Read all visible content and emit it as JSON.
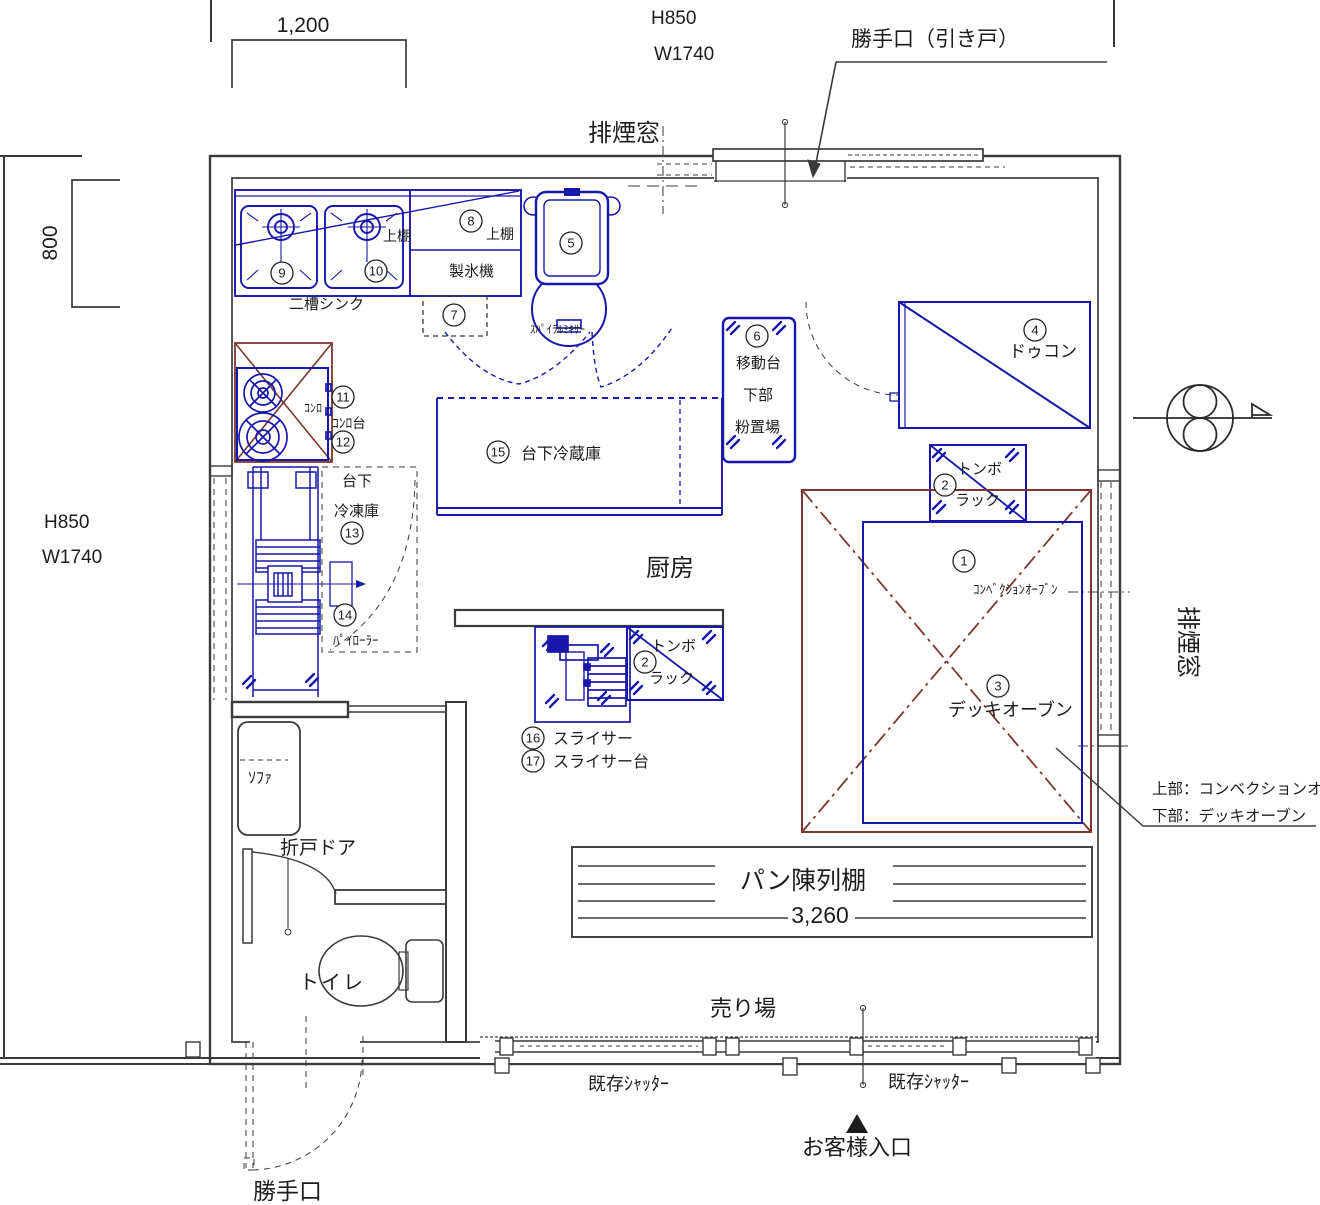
{
  "colors": {
    "line": "#3a3a3a",
    "equipment_blue": "#1717aa",
    "accent_red": "#7c362e"
  },
  "dimensions": {
    "counter_width": "1,200",
    "window_800": "800",
    "top_window": {
      "h": "H850",
      "w": "W1740"
    },
    "left_window": {
      "h": "H850",
      "w": "W1740"
    },
    "shelf_width": "3,260"
  },
  "rooms": {
    "kitchen": "厨房",
    "sales_floor": "売り場",
    "toilet": "トイレ"
  },
  "openings": {
    "back_door_top": "勝手口（引き戸）",
    "smoke_window_top": "排煙窓",
    "smoke_window_right": "排煙窓",
    "folding_door": "折戸ドア",
    "existing_shutter_left": "既存ｼｬｯﾀｰ",
    "existing_shutter_right": "既存ｼｬｯﾀｰ",
    "customer_entrance": "お客様入口",
    "back_door_bottom": "勝手口"
  },
  "fixtures": {
    "double_sink": "二槽シンク",
    "ice_maker": "製氷機",
    "upper_shelf": "上棚",
    "sofa": "ｿﾌｧ",
    "bread_display": "パン陳列棚"
  },
  "equipment": {
    "e1": {
      "no": "1",
      "label": "ｺﾝﾍﾞｸｼｮﾝｵｰﾌﾞﾝ"
    },
    "e2a": {
      "no": "2",
      "line1": "トンボ",
      "line2": "ラック"
    },
    "e2b": {
      "no": "2",
      "line1": "トンボ",
      "line2": "ラック"
    },
    "e3": {
      "no": "3",
      "label": "デッキオーブン"
    },
    "e4": {
      "no": "4",
      "label": "ドゥコン"
    },
    "e5": {
      "no": "5",
      "label": "ｽﾊﾟｲﾗﾙﾐｷｻｰ"
    },
    "e6": {
      "no": "6",
      "line1": "移動台",
      "line2": "下部",
      "line3": "粉置場"
    },
    "e7": {
      "no": "7"
    },
    "e8": {
      "no": "8",
      "label": "上棚"
    },
    "e9": {
      "no": "9"
    },
    "e10": {
      "no": "10"
    },
    "e11": {
      "no": "11",
      "label": "ｺﾝﾛ"
    },
    "e12": {
      "no": "12",
      "label": "ｺﾝﾛ台"
    },
    "e13": {
      "no": "13",
      "line1": "台下",
      "line2": "冷凍庫"
    },
    "e14": {
      "no": "14",
      "label": "ﾊﾟｲﾛｰﾗｰ"
    },
    "e15": {
      "no": "15",
      "label": "台下冷蔵庫"
    },
    "e16": {
      "no": "16",
      "label": "スライサー"
    },
    "e17": {
      "no": "17",
      "label": "スライサー台"
    }
  },
  "notes": {
    "oven_upper": "上部：コンベクションオ",
    "oven_lower": "下部：デッキオーブン"
  }
}
